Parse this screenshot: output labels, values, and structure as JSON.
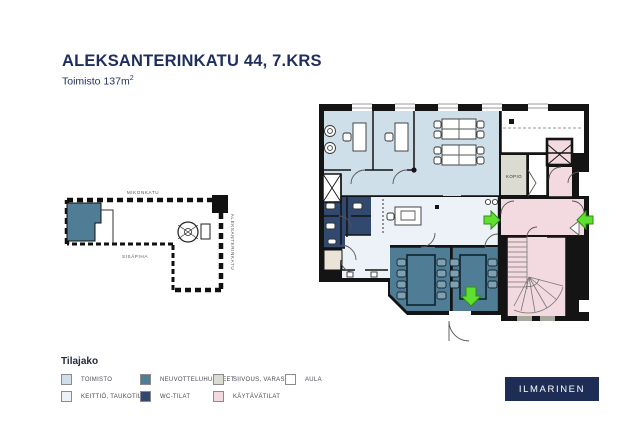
{
  "header": {
    "title": "ALEKSANTERINKATU 44, 7.KRS",
    "subtitle_text": "Toimisto 137m",
    "subtitle_superscript": "2"
  },
  "site_map": {
    "street_top": "MIKONKATU",
    "courtyard_label": "SISÄPIHA",
    "street_right": "ALEKSANTERINKATU"
  },
  "floor_plan": {
    "kopio_label": "KOPIO"
  },
  "legend": {
    "title": "Tilajako",
    "items": [
      {
        "label": "TOIMISTO",
        "color_key": "toimisto"
      },
      {
        "label": "NEUVOTTELUHUONEET",
        "color_key": "neuvotteluhuoneet"
      },
      {
        "label": "SIIVOUS, VARASTO",
        "color_key": "siivous_varasto"
      },
      {
        "label": "AULA",
        "color_key": "aula"
      },
      {
        "label": "KEITTIÖ, TAUKOTILAT",
        "color_key": "keittio_taukotilat"
      },
      {
        "label": "WC-TILAT",
        "color_key": "wc_tilat"
      },
      {
        "label": "KÄYTÄVÄTILAT",
        "color_key": "kaytavatilat"
      }
    ]
  },
  "logo": {
    "text": "ILMARINEN"
  },
  "colors": {
    "title_navy": "#1f2e5e",
    "wall_black": "#141414",
    "toimisto": "#cfdfea",
    "keittio_taukotilat": "#ecf2f7",
    "neuvotteluhuoneet": "#4e7d95",
    "wc_tilat": "#31486f",
    "siivous_varasto": "#dcdbd2",
    "aula": "#ffffff",
    "kaytavatilat": "#f3dae0",
    "beige_room": "#e9e4d7",
    "meeting_chair": "#7fa0b2",
    "entrance_green": "#5fdf2e",
    "entrance_green_border": "#2e8f10",
    "logo_navy": "#1e2d56"
  }
}
